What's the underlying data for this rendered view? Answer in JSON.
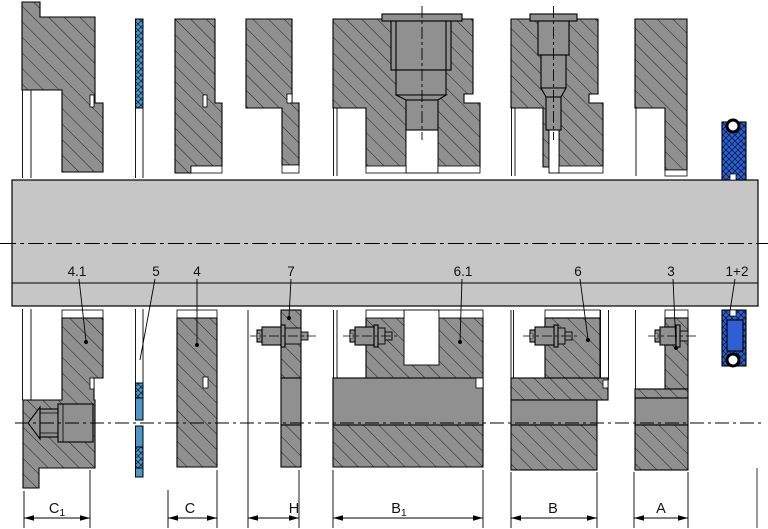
{
  "drawing": {
    "kind": "bearing-assembly-cross-section",
    "part_labels": [
      "4.1",
      "5",
      "4",
      "7",
      "6.1",
      "6",
      "3",
      "1+2"
    ],
    "dimensions": [
      {
        "main": "C",
        "sub": "1"
      },
      {
        "main": "C",
        "sub": ""
      },
      {
        "main": "H",
        "sub": ""
      },
      {
        "main": "B",
        "sub": "1"
      },
      {
        "main": "B",
        "sub": ""
      },
      {
        "main": "A",
        "sub": ""
      }
    ],
    "colors": {
      "part_gray": "#909090",
      "shaft_gray": "#c6c6c6",
      "seal_blue": "#2e5fd3",
      "gasket_blue": "#4e96c8",
      "outline": "#000000"
    }
  }
}
